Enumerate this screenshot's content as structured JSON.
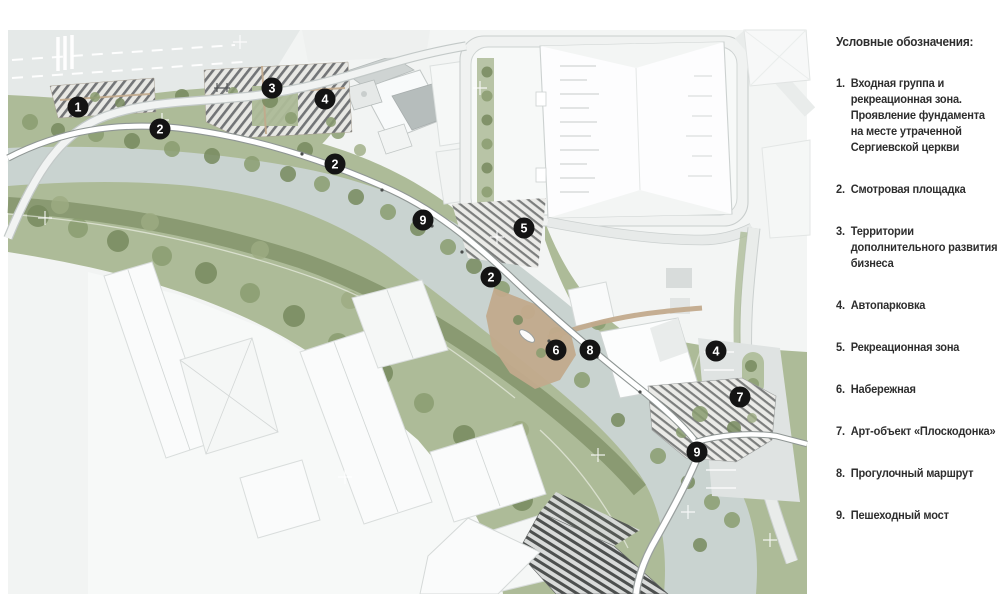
{
  "legend": {
    "title": "Условные обозначения:",
    "items": [
      {
        "num": "1.",
        "text": "Входная группа и рекреационная зона. Проявление фундамента на месте утраченной Сергиевской церкви"
      },
      {
        "num": "2.",
        "text": "Смотровая площадка"
      },
      {
        "num": "3.",
        "text": "Территории дополнительного развития бизнеса"
      },
      {
        "num": "4.",
        "text": "Автопарковка"
      },
      {
        "num": "5.",
        "text": "Рекреационная зона"
      },
      {
        "num": "6.",
        "text": "Набережная"
      },
      {
        "num": "7.",
        "text": "Арт-объект «Плоскодонка»"
      },
      {
        "num": "8.",
        "text": "Прогулочный маршрут"
      },
      {
        "num": "9.",
        "text": "Пешеходный мост"
      }
    ]
  },
  "map": {
    "markers": [
      {
        "label": "1",
        "x": 78,
        "y": 107
      },
      {
        "label": "2",
        "x": 160,
        "y": 129
      },
      {
        "label": "3",
        "x": 272,
        "y": 88
      },
      {
        "label": "4",
        "x": 325,
        "y": 99
      },
      {
        "label": "2",
        "x": 335,
        "y": 164
      },
      {
        "label": "9",
        "x": 423,
        "y": 220
      },
      {
        "label": "5",
        "x": 524,
        "y": 228
      },
      {
        "label": "2",
        "x": 491,
        "y": 277
      },
      {
        "label": "6",
        "x": 556,
        "y": 350
      },
      {
        "label": "8",
        "x": 590,
        "y": 350
      },
      {
        "label": "4",
        "x": 716,
        "y": 351
      },
      {
        "label": "7",
        "x": 740,
        "y": 397
      },
      {
        "label": "9",
        "x": 697,
        "y": 452
      }
    ],
    "colors": {
      "river": "#c9d3d0",
      "green": "#adbb98",
      "green_dark": "#7b8c63",
      "road": "#e4e8e7",
      "deck": "#c2aa8c",
      "marker_bg": "#141414",
      "marker_text": "#ffffff"
    }
  }
}
